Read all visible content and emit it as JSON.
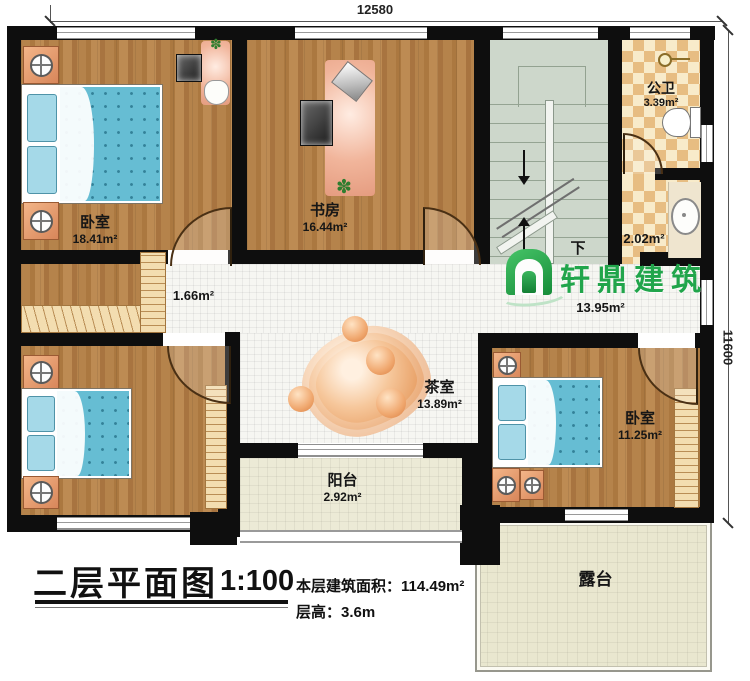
{
  "title_block": {
    "title": "二层平面图",
    "scale": "1:100",
    "area_line": "本层建筑面积：114.49m²",
    "height_line": "层高：3.6m"
  },
  "dimensions": {
    "width_mm": "12580",
    "height_mm": "11600"
  },
  "watermark": {
    "brand": "轩鼎建筑"
  },
  "stairs": {
    "direction_label": "下"
  },
  "rooms": {
    "bedroom1": {
      "name": "卧室",
      "area": "18.41m²"
    },
    "study": {
      "name": "书房",
      "area": "16.44m²"
    },
    "public_bath": {
      "name": "公卫",
      "area": "3.39m²"
    },
    "wash_area": {
      "area": "2.02m²"
    },
    "corridor": {
      "area": "1.66m²"
    },
    "hall": {
      "area": "13.95m²"
    },
    "tea_room": {
      "name": "茶室",
      "area": "13.89m²"
    },
    "bedroom2": {
      "name": "卧室",
      "area": "11.25m²"
    },
    "balcony": {
      "name": "阳台",
      "area": "2.92m²"
    },
    "terrace": {
      "name": "露台"
    }
  },
  "colors": {
    "wall": "#0e0e0e",
    "wood": "#b5834b",
    "bed_blue": "#66bdd3",
    "brand_green": "#21a54b",
    "tile_tan": "#e7bd82"
  }
}
